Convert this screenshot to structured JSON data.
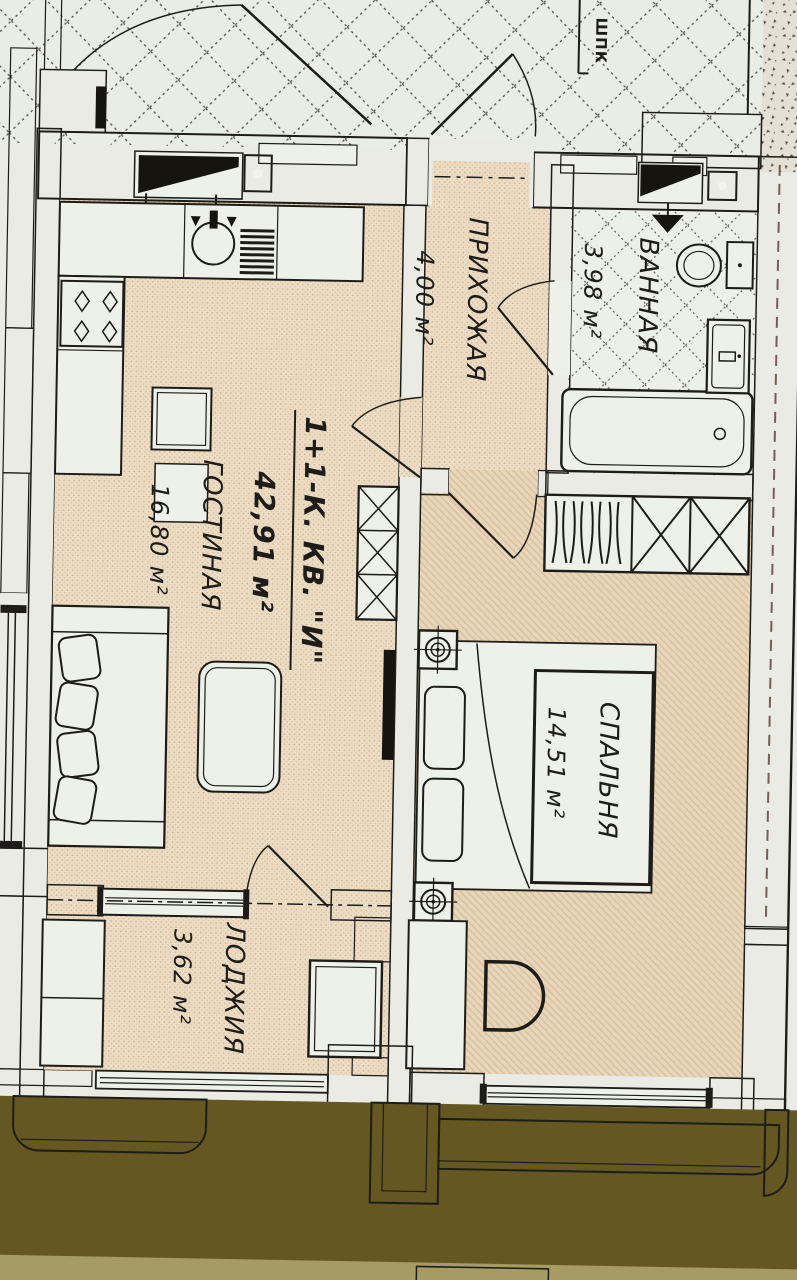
{
  "plan": {
    "type": "apartment-floor-plan",
    "corridor": {
      "cabinet_label": "ШПК"
    },
    "apartment": {
      "title": "1+1-К. КВ. \"И\"",
      "total_area": "42,91 м²",
      "rooms": [
        {
          "name": "ПРИХОЖАЯ",
          "area": "4,00 м²"
        },
        {
          "name": "ВАННАЯ",
          "area": "3,98 м²"
        },
        {
          "name": "ГОСТИНАЯ",
          "area": "16,80 м²"
        },
        {
          "name": "СПАЛЬНЯ",
          "area": "14,51 м²"
        },
        {
          "name": "ЛОДЖИЯ",
          "area": "3,62 м²"
        }
      ]
    },
    "colors": {
      "paper": "#e9ebe4",
      "floor_beige": "#ebdcc3",
      "bearing_wall_red": "#8c4136",
      "vent_shaft_blue": "#3c58a6",
      "outside_olive": "#655722",
      "line": "#1d1c18"
    }
  }
}
